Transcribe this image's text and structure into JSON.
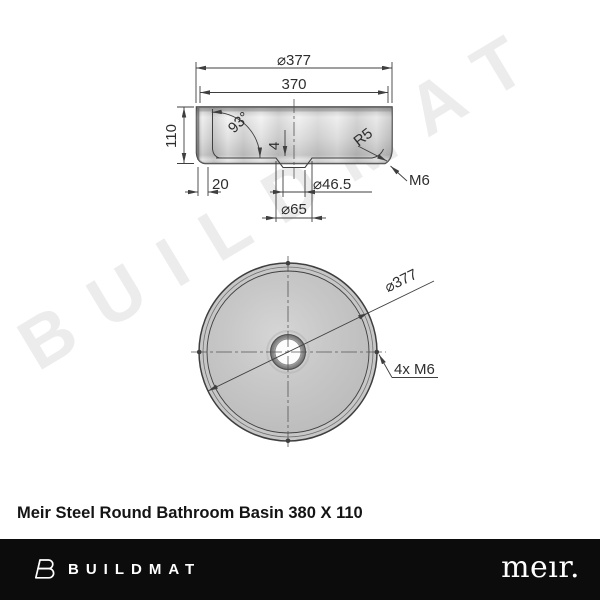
{
  "watermark": {
    "text": "BUILDMAT"
  },
  "drawing": {
    "side_view": {
      "outer_diameter": "⌀377",
      "inner_width": "370",
      "height": "110",
      "wall_angle": "93°",
      "recess_depth": "4",
      "base_inset": "20",
      "drain_recess_diameter": "⌀46.5",
      "drain_diameter": "⌀65",
      "corner_radius": "R5",
      "thread": "M6"
    },
    "top_view": {
      "outer_diameter": "⌀377",
      "mounting_holes": "4x M6"
    }
  },
  "product": {
    "title": "Meir Steel Round Bathroom Basin 380 X 110"
  },
  "footer": {
    "brand_left": "BUILDMAT",
    "brand_right": "meır."
  },
  "colors": {
    "line": "#3f3f3f",
    "text": "#2e2e2e",
    "watermark": "#ececec",
    "footer_background": "#0c0c0c",
    "metal_light": "#e8e8e8",
    "metal_dark": "#9f9f9f"
  }
}
